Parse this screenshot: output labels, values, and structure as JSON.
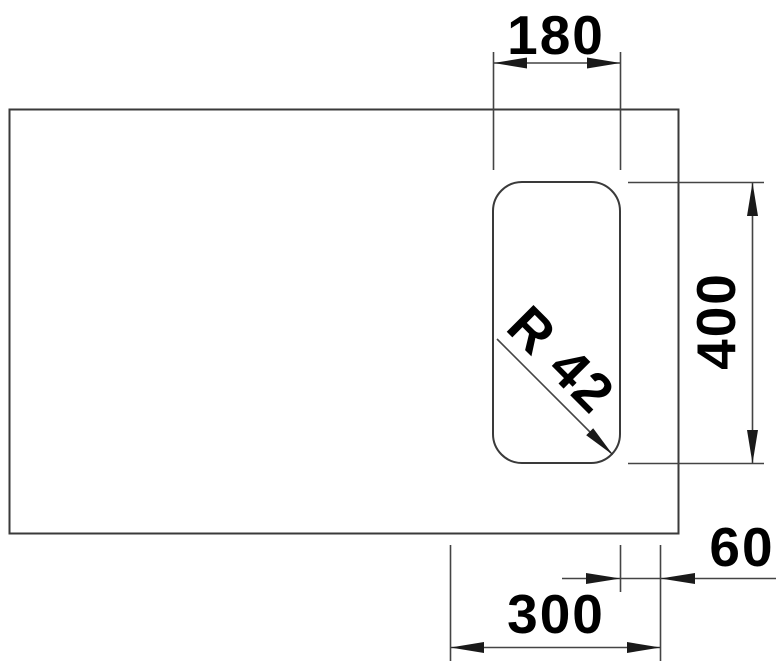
{
  "drawing": {
    "labels": {
      "cutout_width": "180",
      "cutout_height": "400",
      "corner_radius": "R 42",
      "right_offset": "60",
      "bottom_offset": "300"
    }
  }
}
